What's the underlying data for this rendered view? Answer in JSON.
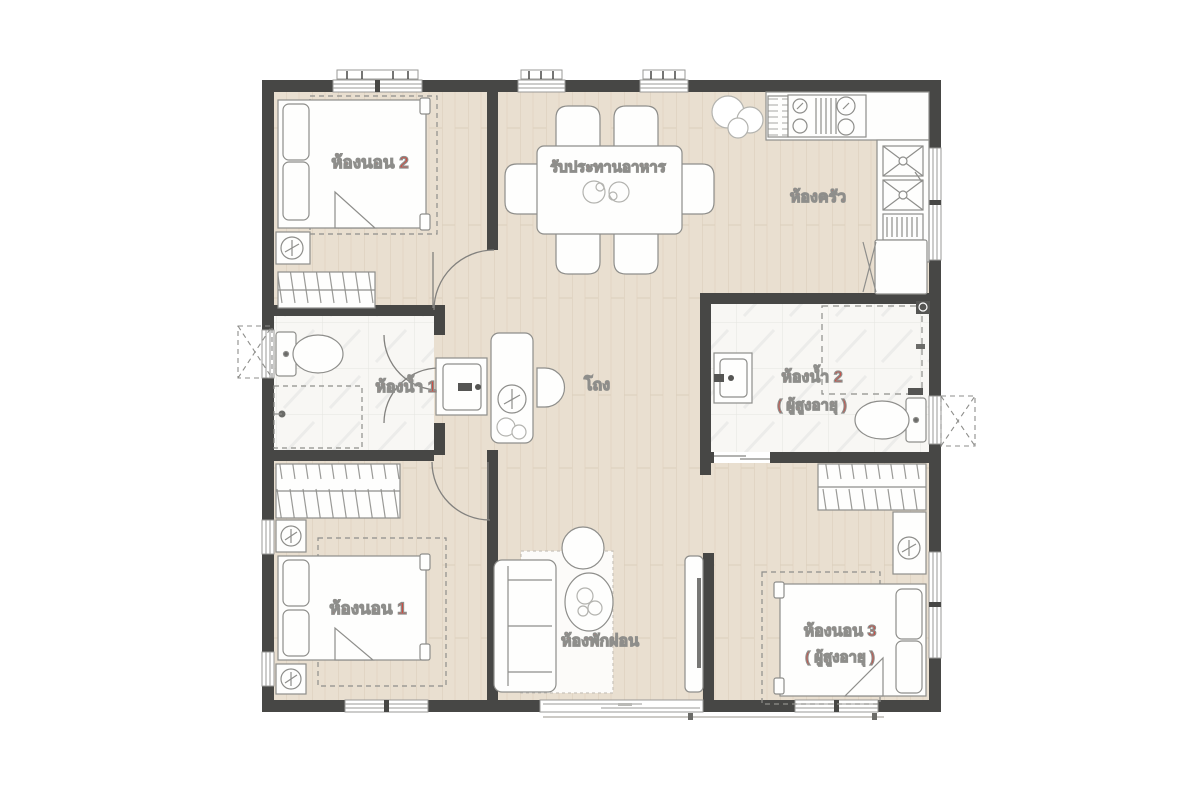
{
  "floor_plan": {
    "colors": {
      "wall": "#474745",
      "wood_floor": "#e9dfd0",
      "tile_floor": "#f8f7f4",
      "label": "#d14a40",
      "furniture_outline": "#8e8e8b",
      "background": "#ffffff"
    },
    "rooms": [
      {
        "id": "bedroom-2",
        "label": "ห้องนอน 2"
      },
      {
        "id": "dining",
        "label": "รับประทานอาหาร"
      },
      {
        "id": "kitchen",
        "label": "ห้องครัว"
      },
      {
        "id": "bathroom-1",
        "label": "ห้องน้ำ 1"
      },
      {
        "id": "hall",
        "label": "โถง"
      },
      {
        "id": "bathroom-2",
        "label": "ห้องน้ำ 2",
        "sublabel": "( ผู้สูงอายุ )"
      },
      {
        "id": "bedroom-1",
        "label": "ห้องนอน 1"
      },
      {
        "id": "living",
        "label": "ห้องพักผ่อน"
      },
      {
        "id": "bedroom-3",
        "label": "ห้องนอน 3",
        "sublabel": "( ผู้สูงอายุ )"
      }
    ]
  }
}
